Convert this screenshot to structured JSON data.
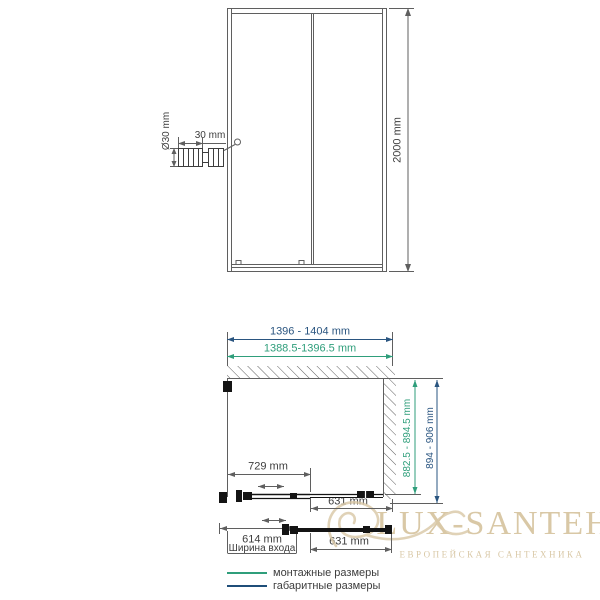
{
  "front_view": {
    "height_dim": "2000 mm",
    "handle_diameter_dim": "Ø30 mm",
    "handle_width_dim": "30 mm"
  },
  "plan_view": {
    "overall_width_dim": "1396 - 1404 mm",
    "mounting_width_dim": "1388.5-1396.5 mm",
    "door_panel_dim": "729 mm",
    "fixed_panel_dim": "631 mm",
    "mounting_depth_dim": "882.5 - 894.5 mm",
    "overall_depth_dim": "894 - 906 mm"
  },
  "entrance_view": {
    "entrance_width_dim": "614 mm",
    "entrance_caption": "Ширина входа",
    "fixed_panel_dim": "631 mm"
  },
  "legend": {
    "mounting_label": "монтажные размеры",
    "overall_label": "габаритные размеры"
  },
  "watermark": {
    "title": "LUX-SANTEH",
    "subtitle": "ЕВРОПЕЙСКАЯ САНТЕХНИКА"
  },
  "colors": {
    "line": "#5f5f5f",
    "detail": "#141414",
    "mounting_green": "#2f9e7b",
    "overall_blue": "#2a5580",
    "legend_blue": "#1f4e79",
    "watermark_tan": "#d9c8a6"
  }
}
